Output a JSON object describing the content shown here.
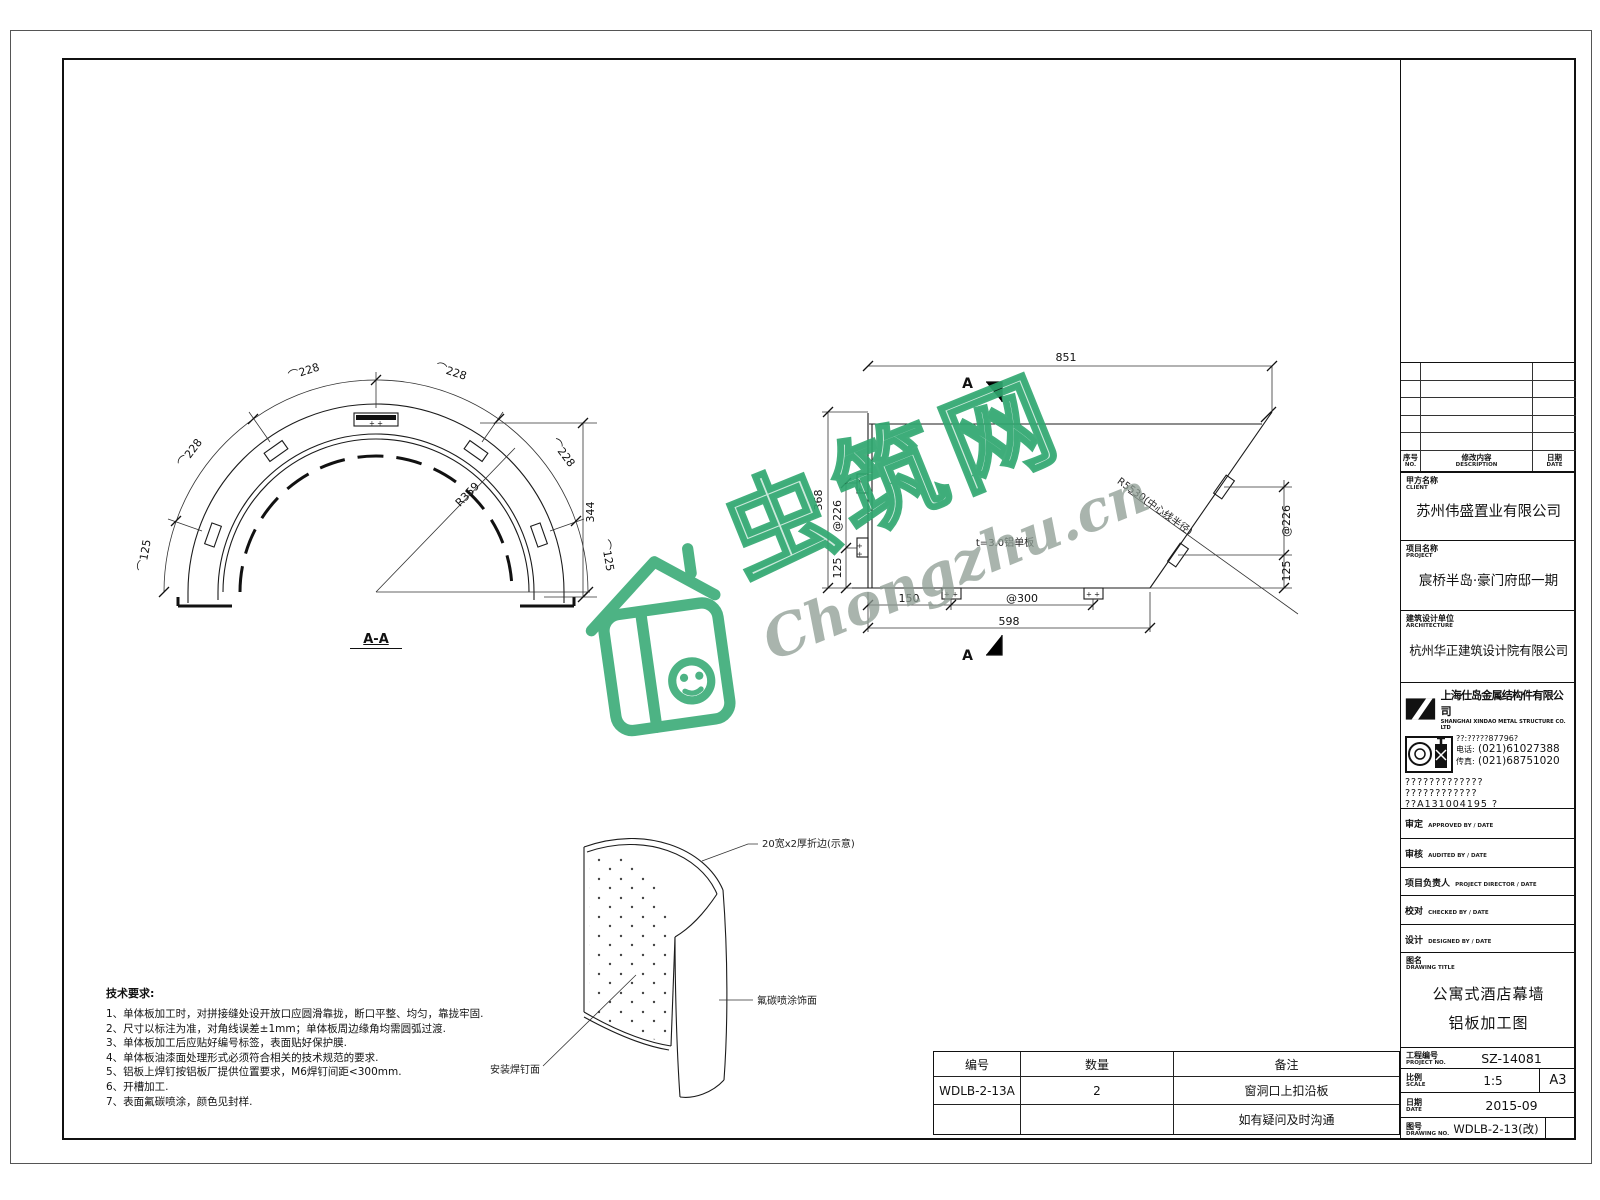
{
  "wm": {
    "brand": "虫筑网",
    "domain": "Chongzhu.cn",
    "color": "#2fa66f"
  },
  "arch": {
    "title": "A-A",
    "arc228": "⌒228",
    "arc125": "⌒125",
    "radius": "R359",
    "height": "344",
    "plus": "+ +"
  },
  "elev": {
    "marker": "A",
    "top": "851",
    "left_total": "368",
    "sp226": "@226",
    "d125": "125",
    "b150": "150",
    "sp300": "@300",
    "b598": "598",
    "radius_note": "R5530(中心线半径)",
    "panel_note": "t=3.0铝单板",
    "plus": "+ +"
  },
  "iso": {
    "top_label": "20宽x2厚折边(示意)",
    "right_label": "氟碳喷涂饰面",
    "bottom_label": "安装焊钉面"
  },
  "notes": {
    "title": "技术要求:",
    "items": [
      "1、单体板加工时，对拼接缝处设开放口应圆滑靠拢，断口平整、均匀，靠拢牢固.",
      "2、尺寸以标注为准，对角线误差±1mm；单体板周边缘角均需圆弧过渡.",
      "3、单体板加工后应贴好编号标签，表面贴好保护膜.",
      "4、单体板油漆面处理形式必须符合相关的技术规范的要求.",
      "5、铝板上焊钉按铝板厂提供位置要求，M6焊钉间距<300mm.",
      "6、开槽加工.",
      "7、表面氟碳喷涂，颜色见封样."
    ]
  },
  "parts": {
    "h1": "编号",
    "h2": "数量",
    "h3": "备注",
    "r1c1": "WDLB-2-13A",
    "r1c2": "2",
    "r1c3": "窗洞口上扣沿板",
    "r2c3": "如有疑问及时沟通"
  },
  "tb": {
    "rev": {
      "c1": "序号",
      "c1e": "NO.",
      "c2": "修改内容",
      "c2e": "DESCRIPTION",
      "c3": "日期",
      "c3e": "DATE"
    },
    "client": {
      "l": "甲方名称",
      "le": "CLIENT",
      "v": "苏州伟盛置业有限公司"
    },
    "project": {
      "l": "项目名称",
      "le": "PROJECT",
      "v": "宸桥半岛·豪门府邸一期"
    },
    "archi": {
      "l": "建筑设计单位",
      "le": "ARCHITECTURE",
      "v": "杭州华正建筑设计院有限公司"
    },
    "co": {
      "name": "上海仕岛金属结构件有限公司",
      "en": "SHANGHAI XINDAO METAL STRUCTURE CO. LTD",
      "l1": "??:?????87796?",
      "tel_l": "电话:",
      "tel": "(021)61027388",
      "fax_l": "传真:",
      "fax": "(021)68751020",
      "g1": "?????????????",
      "g2": "????????????",
      "g3": "??A131004195 ?"
    },
    "signs": [
      {
        "l": "审定",
        "e": "APPROVED BY / DATE"
      },
      {
        "l": "审核",
        "e": "AUDITED BY / DATE"
      },
      {
        "l": "项目负责人",
        "e": "PROJECT DIRECTOR / DATE"
      },
      {
        "l": "校对",
        "e": "CHECKED BY / DATE"
      },
      {
        "l": "设计",
        "e": "DESIGNED BY / DATE"
      }
    ],
    "title": {
      "l": "图名",
      "le": "DRAWING TITLE",
      "v1": "公寓式酒店幕墙",
      "v2": "铝板加工图"
    },
    "pno": {
      "l": "工程编号",
      "le": "PROJECT NO.",
      "v": "SZ-14081"
    },
    "scale": {
      "l": "比例",
      "le": "SCALE",
      "v": "1:5",
      "sheet": "A3"
    },
    "date": {
      "l": "日期",
      "le": "DATE",
      "v": "2015-09"
    },
    "dno": {
      "l": "图号",
      "le": "DRAWING NO.",
      "v": "WDLB-2-13(改)"
    }
  }
}
